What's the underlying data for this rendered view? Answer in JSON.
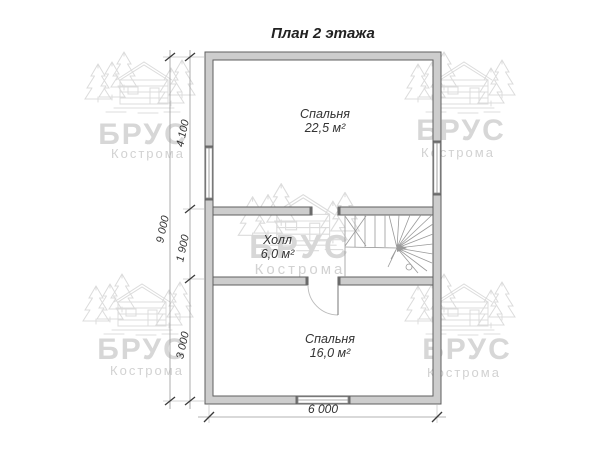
{
  "title": "План 2 этажа",
  "rooms": {
    "bedroom_top": {
      "name": "Спальня",
      "area": "22,5 м²"
    },
    "hall": {
      "name": "Холл",
      "area": "6,0 м²"
    },
    "bedroom_bottom": {
      "name": "Спальня",
      "area": "16,0 м²"
    }
  },
  "dimensions": {
    "left_total": "9 000",
    "left_top": "4 100",
    "left_middle": "1 900",
    "left_bottom": "3 000",
    "bottom_width": "6 000"
  },
  "watermark": {
    "brand": "БРУС",
    "city": "Кострома"
  },
  "colors": {
    "wall_fill": "#cdcdcd",
    "wall_stroke": "#5f5f5f",
    "stair_line": "#9a9a9a",
    "dim_line": "#9a9a9a",
    "text": "#333333",
    "watermark": "#d7d7d7"
  }
}
